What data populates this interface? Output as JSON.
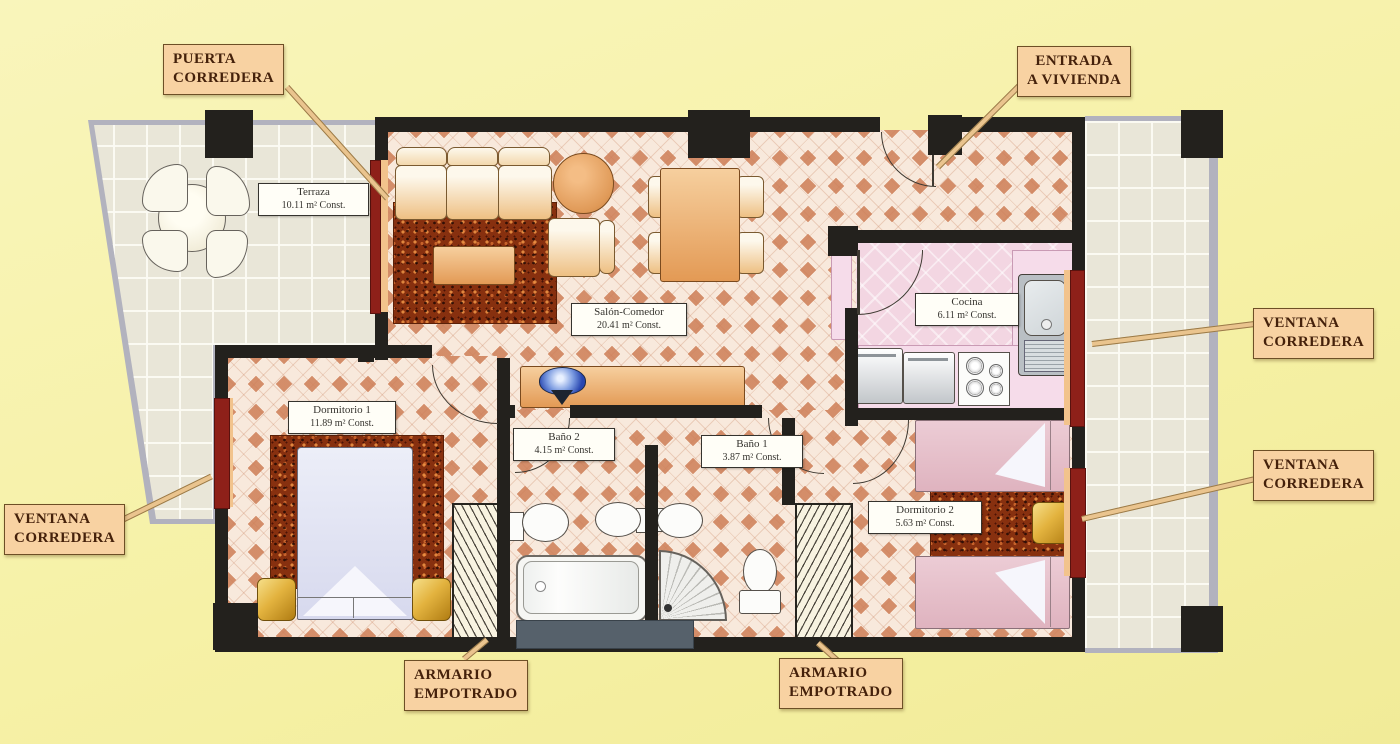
{
  "callouts": {
    "puerta_corredera": {
      "line1": "PUERTA",
      "line2": "CORREDERA"
    },
    "entrada_a_vivienda": {
      "line1": "ENTRADA",
      "line2": "A VIVIENDA"
    },
    "ventana_corredera_right_top": {
      "line1": "VENTANA",
      "line2": "CORREDERA"
    },
    "ventana_corredera_right_bottom": {
      "line1": "VENTANA",
      "line2": "CORREDERA"
    },
    "ventana_corredera_left": {
      "line1": "VENTANA",
      "line2": "CORREDERA"
    },
    "armario_empotrado_left": {
      "line1": "ARMARIO",
      "line2": "EMPOTRADO"
    },
    "armario_empotrado_right": {
      "line1": "ARMARIO",
      "line2": "EMPOTRADO"
    }
  },
  "rooms": {
    "terraza": {
      "name": "Terraza",
      "area": "10.11 m² Const."
    },
    "salon_comedor": {
      "name": "Salón-Comedor",
      "area": "20.41 m² Const."
    },
    "cocina": {
      "name": "Cocina",
      "area": "6.11 m² Const."
    },
    "dormitorio_1": {
      "name": "Dormitorio 1",
      "area": "11.89 m² Const."
    },
    "bano_2": {
      "name": "Baño 2",
      "area": "4.15 m² Const."
    },
    "bano_1": {
      "name": "Baño 1",
      "area": "3.87 m² Const."
    },
    "dormitorio_2": {
      "name": "Dormitorio 2",
      "area": "5.63 m² Const."
    }
  },
  "colors": {
    "background": "#f6f1a6",
    "wall": "#23211d",
    "window_red": "#8e2019",
    "window_trim_peach": "#f2c38c",
    "callout_bg": "#f8d2a2",
    "callout_text": "#45210b",
    "floor_base": "#f8e9dc",
    "floor_diamond": "#cd7d55",
    "terrace_tile": "#e9e6d8",
    "kitchen_floor": "#f3d6e2",
    "rug": "#87300f",
    "furniture_wood": "#e39a55",
    "nightstand_gold": "#e3b33f"
  }
}
